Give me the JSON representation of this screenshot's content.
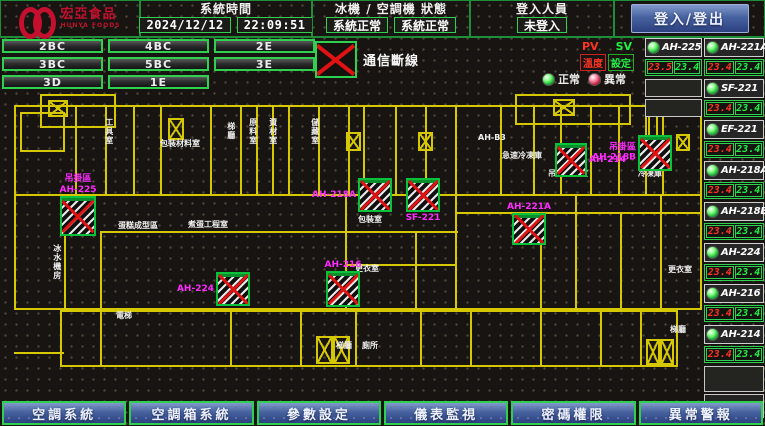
{
  "header": {
    "logo_title": "宏亞食品",
    "logo_subtitle": "HUNYA FOODS",
    "time_label": "系統時間",
    "date_value": "2024/12/12",
    "time_value": "22:09:51",
    "status_label": "冰機 / 空調機 狀態",
    "chiller_status": "系統正常",
    "ahu_status": "系統正常",
    "login_label": "登入人員",
    "login_value": "未登入",
    "login_button": "登入/登出"
  },
  "floors": [
    "2BC",
    "4BC",
    "2E",
    "3BC",
    "5BC",
    "3E",
    "3D",
    "1E"
  ],
  "comm_alarm": {
    "label": "通信斷線"
  },
  "legend": {
    "pv": "PV",
    "sv": "SV",
    "temp": "溫度",
    "setting": "設定",
    "normal": "正常",
    "abnormal": "異常"
  },
  "units": {
    "colA": [
      {
        "name": "AH-225",
        "pv": "23.5",
        "sv": "23.4",
        "status": "normal"
      }
    ],
    "colB": [
      {
        "name": "AH-221A",
        "pv": "23.4",
        "sv": "23.4",
        "status": "normal"
      },
      {
        "name": "SF-221",
        "pv": "23.4",
        "sv": "23.4",
        "status": "normal"
      },
      {
        "name": "EF-221",
        "pv": "23.4",
        "sv": "23.4",
        "status": "normal"
      },
      {
        "name": "AH-218A",
        "pv": "23.4",
        "sv": "23.4",
        "status": "normal"
      },
      {
        "name": "AH-218B",
        "pv": "23.4",
        "sv": "23.4",
        "status": "normal"
      },
      {
        "name": "AH-224",
        "pv": "23.4",
        "sv": "23.4",
        "status": "normal"
      },
      {
        "name": "AH-216",
        "pv": "23.4",
        "sv": "23.4",
        "status": "normal"
      },
      {
        "name": "AH-214",
        "pv": "23.4",
        "sv": "23.4",
        "status": "normal"
      }
    ]
  },
  "floorplan": {
    "devices": [
      {
        "name": "AH-225",
        "area": "吊掛區",
        "x": 60,
        "y": 104,
        "w": 32,
        "h": 36,
        "label_pos": "above",
        "state": "comm-fail"
      },
      {
        "name": "AH-218A",
        "x": 358,
        "y": 86,
        "w": 30,
        "h": 30,
        "label_pos": "left",
        "state": "comm-fail"
      },
      {
        "name": "SF-221",
        "x": 406,
        "y": 86,
        "w": 30,
        "h": 30,
        "label_pos": "below",
        "state": "comm-fail"
      },
      {
        "name": "AH-221A",
        "x": 512,
        "y": 121,
        "w": 30,
        "h": 28,
        "label_pos": "above",
        "state": "comm-fail"
      },
      {
        "name": "AH-214",
        "x": 555,
        "y": 51,
        "w": 28,
        "h": 30,
        "label_pos": "right",
        "state": "comm-fail"
      },
      {
        "name": "AH-218B",
        "area": "吊掛區",
        "x": 638,
        "y": 43,
        "w": 30,
        "h": 32,
        "label_pos": "left",
        "state": "comm-fail"
      },
      {
        "name": "AH-224",
        "x": 216,
        "y": 180,
        "w": 30,
        "h": 30,
        "label_pos": "left",
        "state": "comm-fail"
      },
      {
        "name": "AH-216",
        "x": 326,
        "y": 179,
        "w": 30,
        "h": 32,
        "label_pos": "above",
        "state": "comm-fail"
      }
    ],
    "rooms": [
      {
        "t": "工具室",
        "x": 104,
        "y": 26,
        "vert": true
      },
      {
        "t": "包裝材料室",
        "x": 160,
        "y": 48
      },
      {
        "t": "梯廳",
        "x": 226,
        "y": 30,
        "vert": true
      },
      {
        "t": "原料室",
        "x": 248,
        "y": 26,
        "vert": true
      },
      {
        "t": "資材室",
        "x": 268,
        "y": 26,
        "vert": true
      },
      {
        "t": "儲藏室",
        "x": 310,
        "y": 26,
        "vert": true
      },
      {
        "t": "AH-B3",
        "x": 478,
        "y": 42
      },
      {
        "t": "急速冷凍庫",
        "x": 502,
        "y": 60
      },
      {
        "t": "吊掛冷凍室",
        "x": 548,
        "y": 78
      },
      {
        "t": "冷凍庫",
        "x": 638,
        "y": 78
      },
      {
        "t": "蛋糕成型區",
        "x": 118,
        "y": 130
      },
      {
        "t": "煮蛋工程室",
        "x": 188,
        "y": 129
      },
      {
        "t": "包裝室",
        "x": 358,
        "y": 124
      },
      {
        "t": "更衣室",
        "x": 355,
        "y": 173
      },
      {
        "t": "更衣室",
        "x": 668,
        "y": 174
      },
      {
        "t": "冰水機房",
        "x": 52,
        "y": 152,
        "vert": true
      },
      {
        "t": "電梯",
        "x": 116,
        "y": 220
      },
      {
        "t": "梯廳",
        "x": 336,
        "y": 250
      },
      {
        "t": "廁所",
        "x": 362,
        "y": 250
      },
      {
        "t": "梯廳",
        "x": 670,
        "y": 234
      }
    ],
    "stairs": [
      {
        "x": 48,
        "y": 8,
        "w": 20,
        "h": 17
      },
      {
        "x": 553,
        "y": 7,
        "w": 22,
        "h": 17
      },
      {
        "x": 168,
        "y": 26,
        "w": 16,
        "h": 22
      },
      {
        "x": 346,
        "y": 40,
        "w": 15,
        "h": 19
      },
      {
        "x": 418,
        "y": 40,
        "w": 15,
        "h": 19
      },
      {
        "x": 676,
        "y": 42,
        "w": 14,
        "h": 17
      },
      {
        "x": 316,
        "y": 244,
        "w": 17,
        "h": 28
      },
      {
        "x": 333,
        "y": 244,
        "w": 17,
        "h": 28
      },
      {
        "x": 646,
        "y": 247,
        "w": 14,
        "h": 26
      },
      {
        "x": 660,
        "y": 247,
        "w": 14,
        "h": 26
      }
    ]
  },
  "nav": [
    "空調系統",
    "空調箱系統",
    "參數設定",
    "儀表監視",
    "密碼權限",
    "異常警報"
  ],
  "colors": {
    "accent_green": "#2fcf50",
    "alarm_red": "#e01212",
    "device_label_magenta": "#ff2bff",
    "pv_red": "#ff3322",
    "sv_green": "#22ee44",
    "wall_yellow": "#d6c800",
    "button_blue": "#47639f",
    "logo_red": "#c40f2e"
  }
}
